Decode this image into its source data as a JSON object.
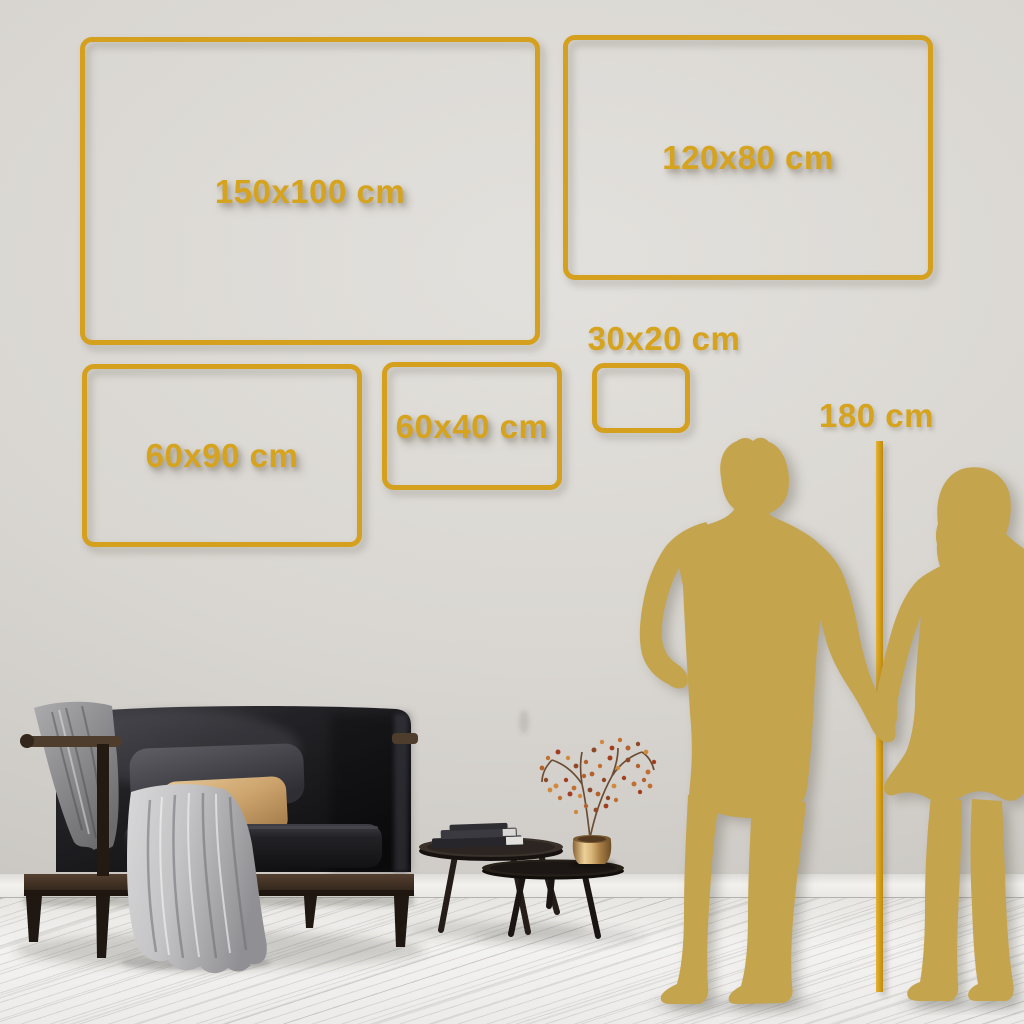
{
  "size_frames": [
    {
      "label": "150x100 cm",
      "width_cm": 150,
      "height_cm": 100
    },
    {
      "label": "120x80 cm",
      "width_cm": 120,
      "height_cm": 80
    },
    {
      "label": "60x90 cm",
      "width_cm": 60,
      "height_cm": 90
    },
    {
      "label": "60x40 cm",
      "width_cm": 60,
      "height_cm": 40
    },
    {
      "label": "30x20 cm",
      "width_cm": 30,
      "height_cm": 20
    }
  ],
  "height_marker": {
    "label": "180 cm",
    "height_cm": 180
  },
  "colors": {
    "accent_gold": "#D5A01E",
    "silhouette_gold": "#C5A44E",
    "wall": "#D8D5D0",
    "floor": "#F0EFED"
  }
}
